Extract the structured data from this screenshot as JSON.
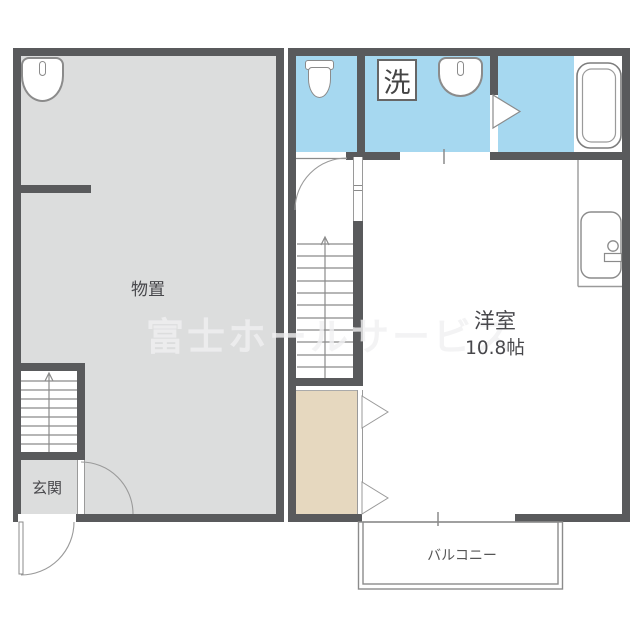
{
  "watermark": "富士ホールサービス",
  "left_plan": {
    "storage_label": "物置",
    "entrance_label": "玄関"
  },
  "right_plan": {
    "room_label": "洋室",
    "room_size": "10.8帖",
    "laundry_label": "洗",
    "balcony_label": "バルコニー"
  },
  "colors": {
    "wall": "#595a5c",
    "floor_gray": "#dcdddd",
    "wet_area_blue": "#a6d8f0",
    "closet_beige": "#e6d8bf",
    "background": "#ffffff"
  }
}
